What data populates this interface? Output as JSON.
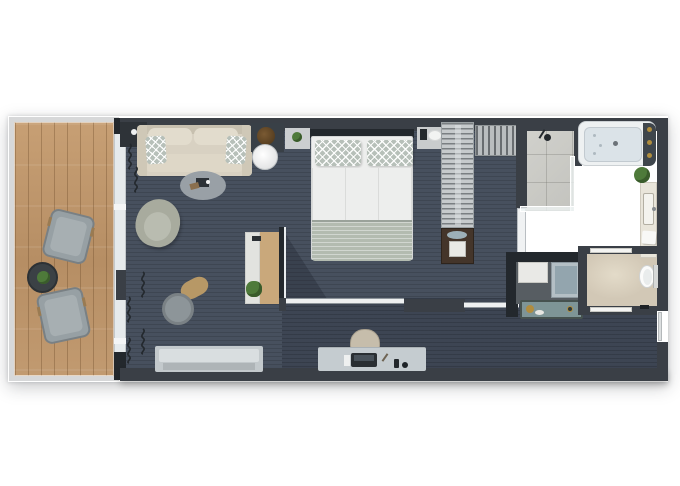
{
  "plan": {
    "kind": "suite-floor-plan-top-view",
    "rooms": [
      {
        "name": "balcony",
        "floor": "wood-deck",
        "furniture": [
          "lounge-chair",
          "lounge-chair",
          "round-side-table",
          "potted-plant"
        ]
      },
      {
        "name": "living-area",
        "floor": "carpet",
        "furniture": [
          "sofa",
          "throw-pillow",
          "throw-pillow",
          "coffee-table-rug",
          "armchair",
          "tv-cabinet",
          "side-table-with-lamp",
          "swivel-chair",
          "window-bench",
          "writing-desk",
          "desk-plant"
        ]
      },
      {
        "name": "sleeping-area",
        "floor": "carpet",
        "furniture": [
          "double-bed",
          "bed-pillow",
          "bed-pillow",
          "nightstand",
          "nightstand",
          "table-lamp",
          "table-lamp",
          "wardrobe-rail",
          "closet-rail",
          "minibar-safe-cabinet"
        ]
      },
      {
        "name": "bathroom",
        "floor": "marble",
        "furniture": [
          "walk-in-shower",
          "shower-head",
          "bathtub",
          "vanity-counter",
          "sink",
          "potted-plant",
          "towel",
          "wash-basin",
          "luggage-counter"
        ]
      },
      {
        "name": "wc",
        "floor": "marble",
        "furniture": [
          "toilet",
          "door",
          "door"
        ]
      },
      {
        "name": "corridor",
        "floor": "carpet",
        "furniture": [
          "work-desk",
          "desk-chair",
          "laptop-tray",
          "phone",
          "notepad",
          "minibar-console",
          "kettle",
          "sliding-door",
          "sliding-door",
          "entry-door"
        ]
      }
    ],
    "window_wall": {
      "side": "left",
      "elements": [
        "glass-sliding-panels",
        "curtains"
      ]
    },
    "palette": {
      "wall": "#3a3f46",
      "wall_dark": "#23282d",
      "carpet": "#47505e",
      "carpet_dark": "#3d4553",
      "wood": "#bf9a6f",
      "frame": "#d7d8d9",
      "glass": "#e6eaec",
      "sofa": "#d8d1c2",
      "pillow": "#b7c0b9",
      "rug": "#99a0a6",
      "armchair": "#a8ab9e",
      "bench": "#ced4d6",
      "duvet": "#edeeed",
      "blanket": "#b3bbb0",
      "closet": "#c6cacc",
      "cabinet": "#44352a",
      "marble": "#d6ccba",
      "marble_wc": "#d2c8b6",
      "tile": "#c9c9c4",
      "tub": "#dbe3e8",
      "console": "#7e9596",
      "desk": "#c5ccd0",
      "wood_desk": "#c9a87b",
      "gold": "#b08d3e",
      "plant": "#4e7a3a"
    }
  }
}
